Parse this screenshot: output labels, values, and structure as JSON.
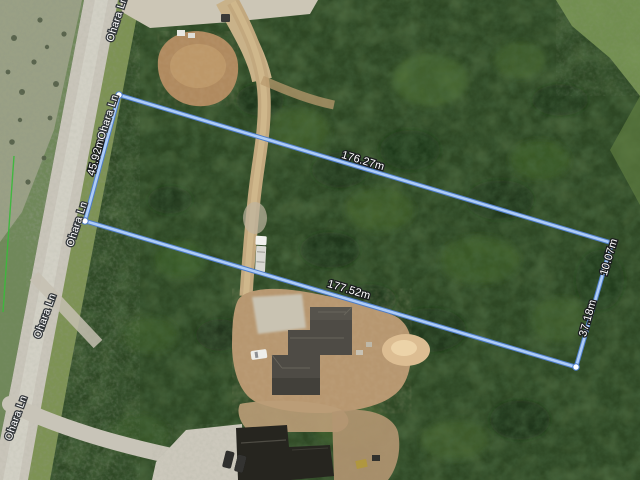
{
  "map": {
    "view_type": "satellite",
    "road_name": "Ohara Ln",
    "measurement_overlay": {
      "tool": "distance-measurement",
      "segments": {
        "top_edge": "176.27m",
        "bottom_edge": "177.52m",
        "left_edge": "45.92m",
        "right_edge_upper": "10.07m",
        "right_edge_lower": "37.18m"
      },
      "colors": {
        "line_core": "#aecdf7",
        "line_casing": "#4f7ec9",
        "vertex_fill": "#ffffff",
        "vertex_stroke": "#4f7ec9",
        "label_text": "#ffffff",
        "label_halo": "#1b1d1f"
      }
    },
    "parcel_line_color": "#3cb83c",
    "terrain": {
      "forest": "#2e4724",
      "field": "#9aa085",
      "road_surface": "#c9c5ba",
      "dirt": "#b08a5f",
      "sand_pile": "#dcbd92",
      "roof_main": "#4e4b45",
      "roof_dark_house": "#26251f"
    }
  }
}
